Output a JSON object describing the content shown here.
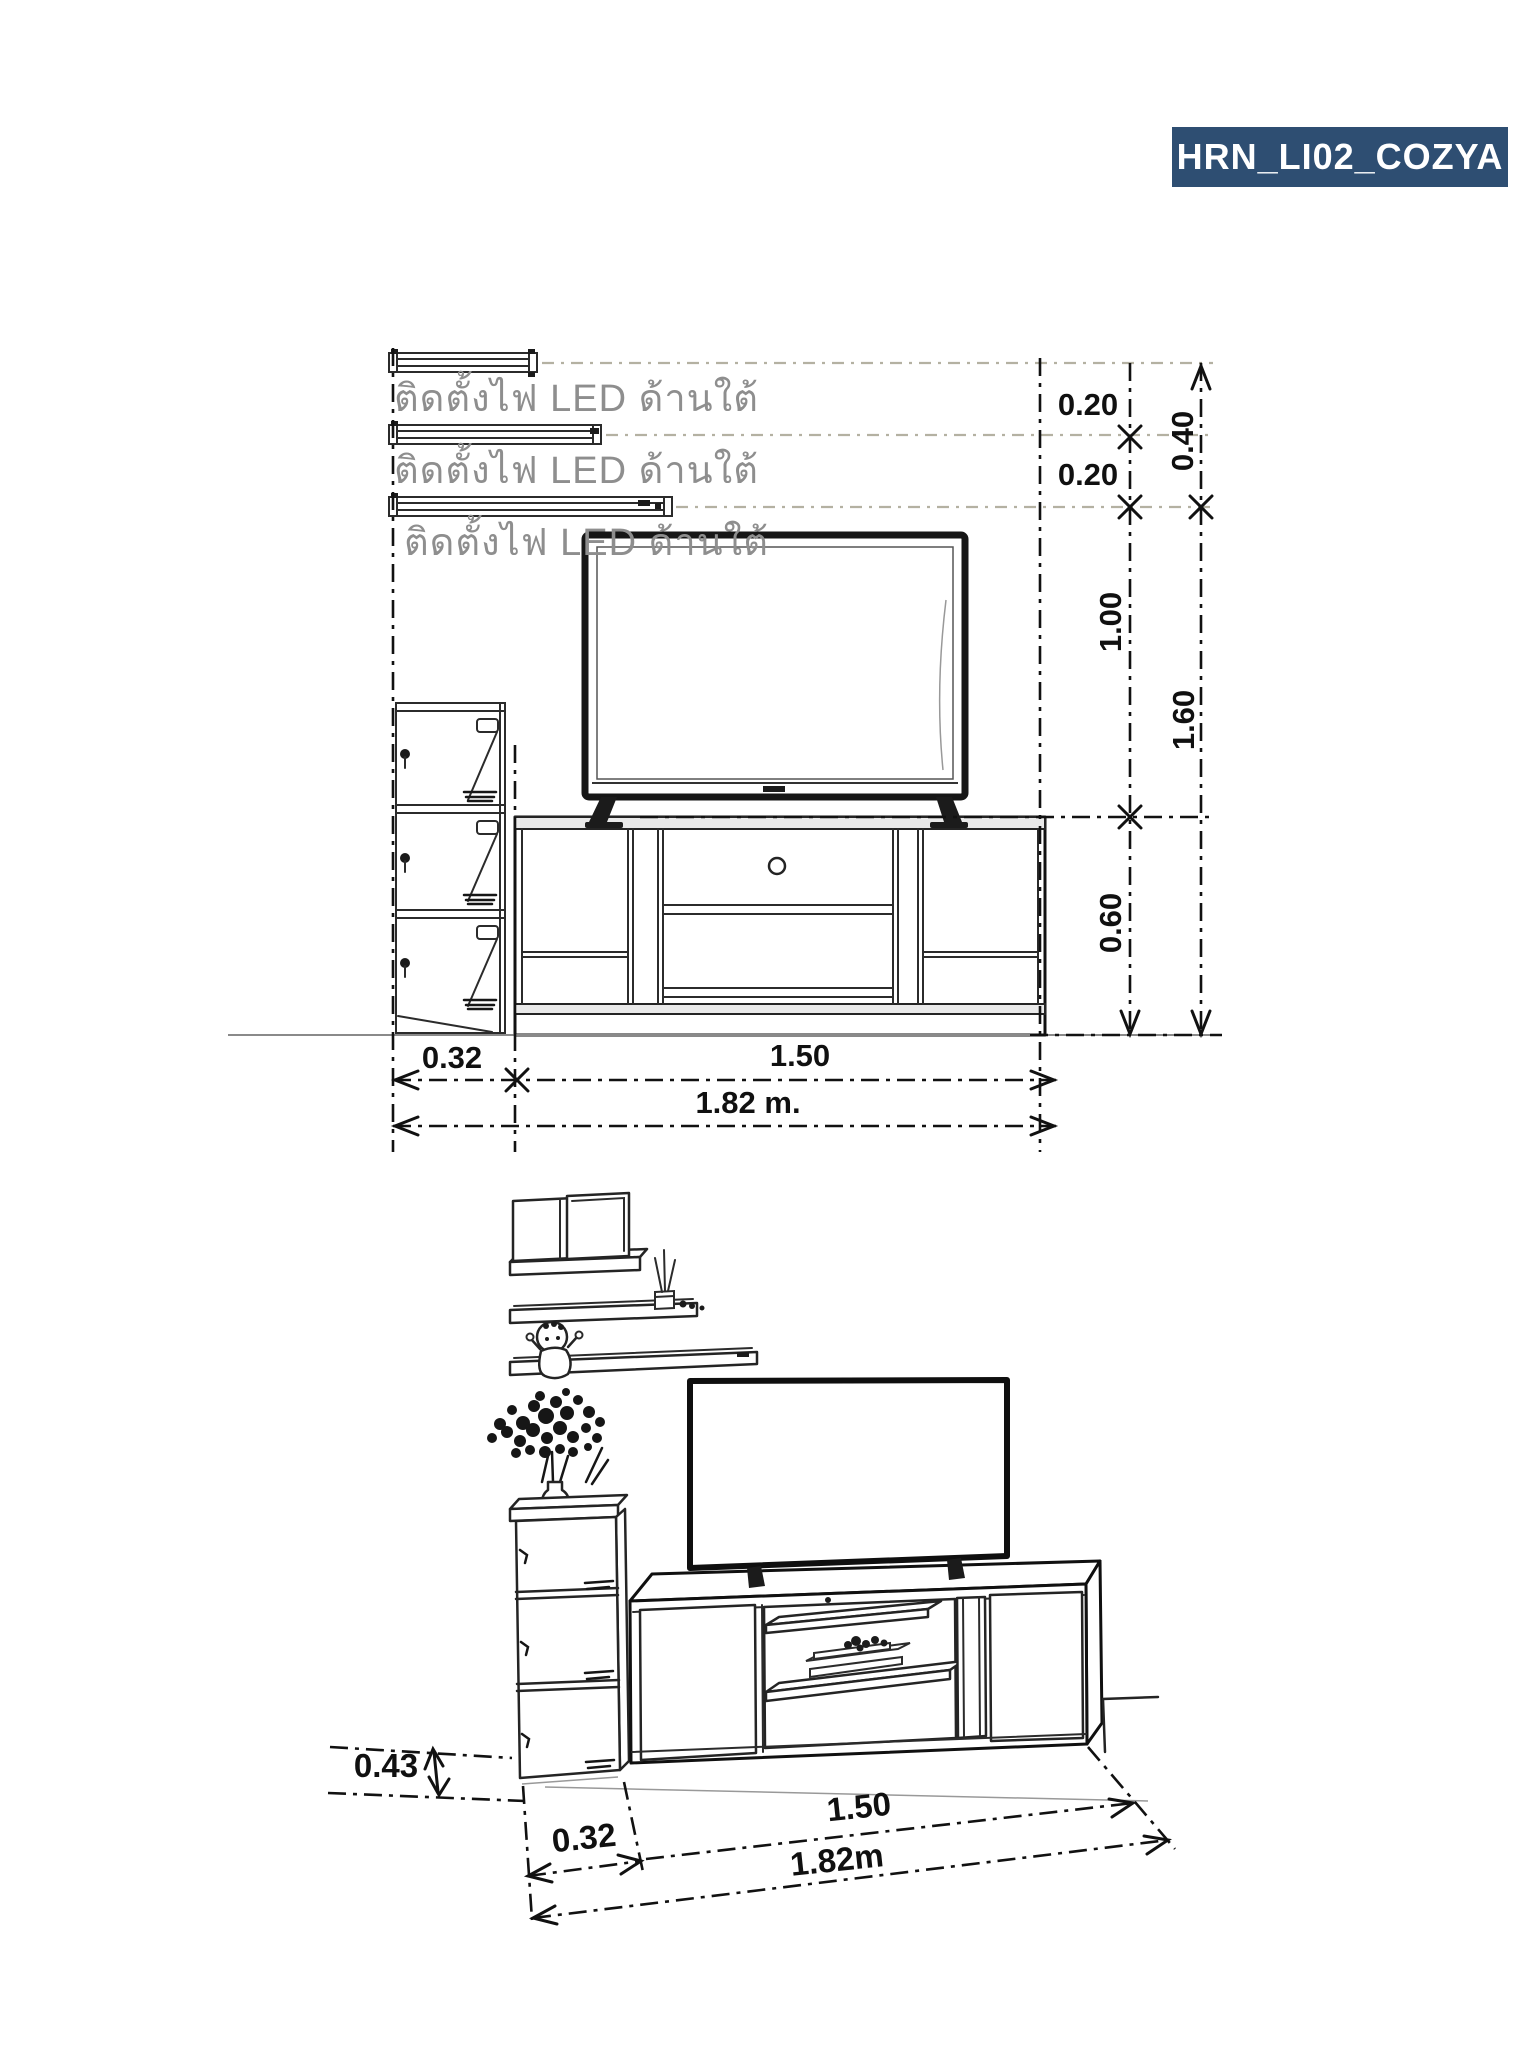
{
  "badge": {
    "label": "HRN_LI02_COZYA",
    "bg": "#2e4e72",
    "fg": "#ffffff"
  },
  "elevation": {
    "led_notes": [
      "ติดตั้งไฟ LED ด้านใต้",
      "ติดตั้งไฟ LED ด้านใต้",
      "ติดตั้งไฟ LED ด้านใต้"
    ],
    "dims": {
      "led_gap_1": "0.20",
      "led_gap_2": "0.20",
      "led_zone_total": "0.40",
      "tv_zone_height": "1.00",
      "wall_unit_height": "1.60",
      "stand_height": "0.60",
      "cabinet_width": "0.32",
      "stand_width": "1.50",
      "total_width": "1.82 m."
    }
  },
  "perspective": {
    "dims": {
      "cabinet_depth": "0.43",
      "cabinet_width": "0.32",
      "stand_width": "1.50",
      "total_width": "1.82m"
    }
  },
  "colors": {
    "line": "#1f1f1f",
    "guide_gray": "#b4b1a2",
    "note_text": "#8e8e8e",
    "badge_blue": "#2e4e72"
  }
}
